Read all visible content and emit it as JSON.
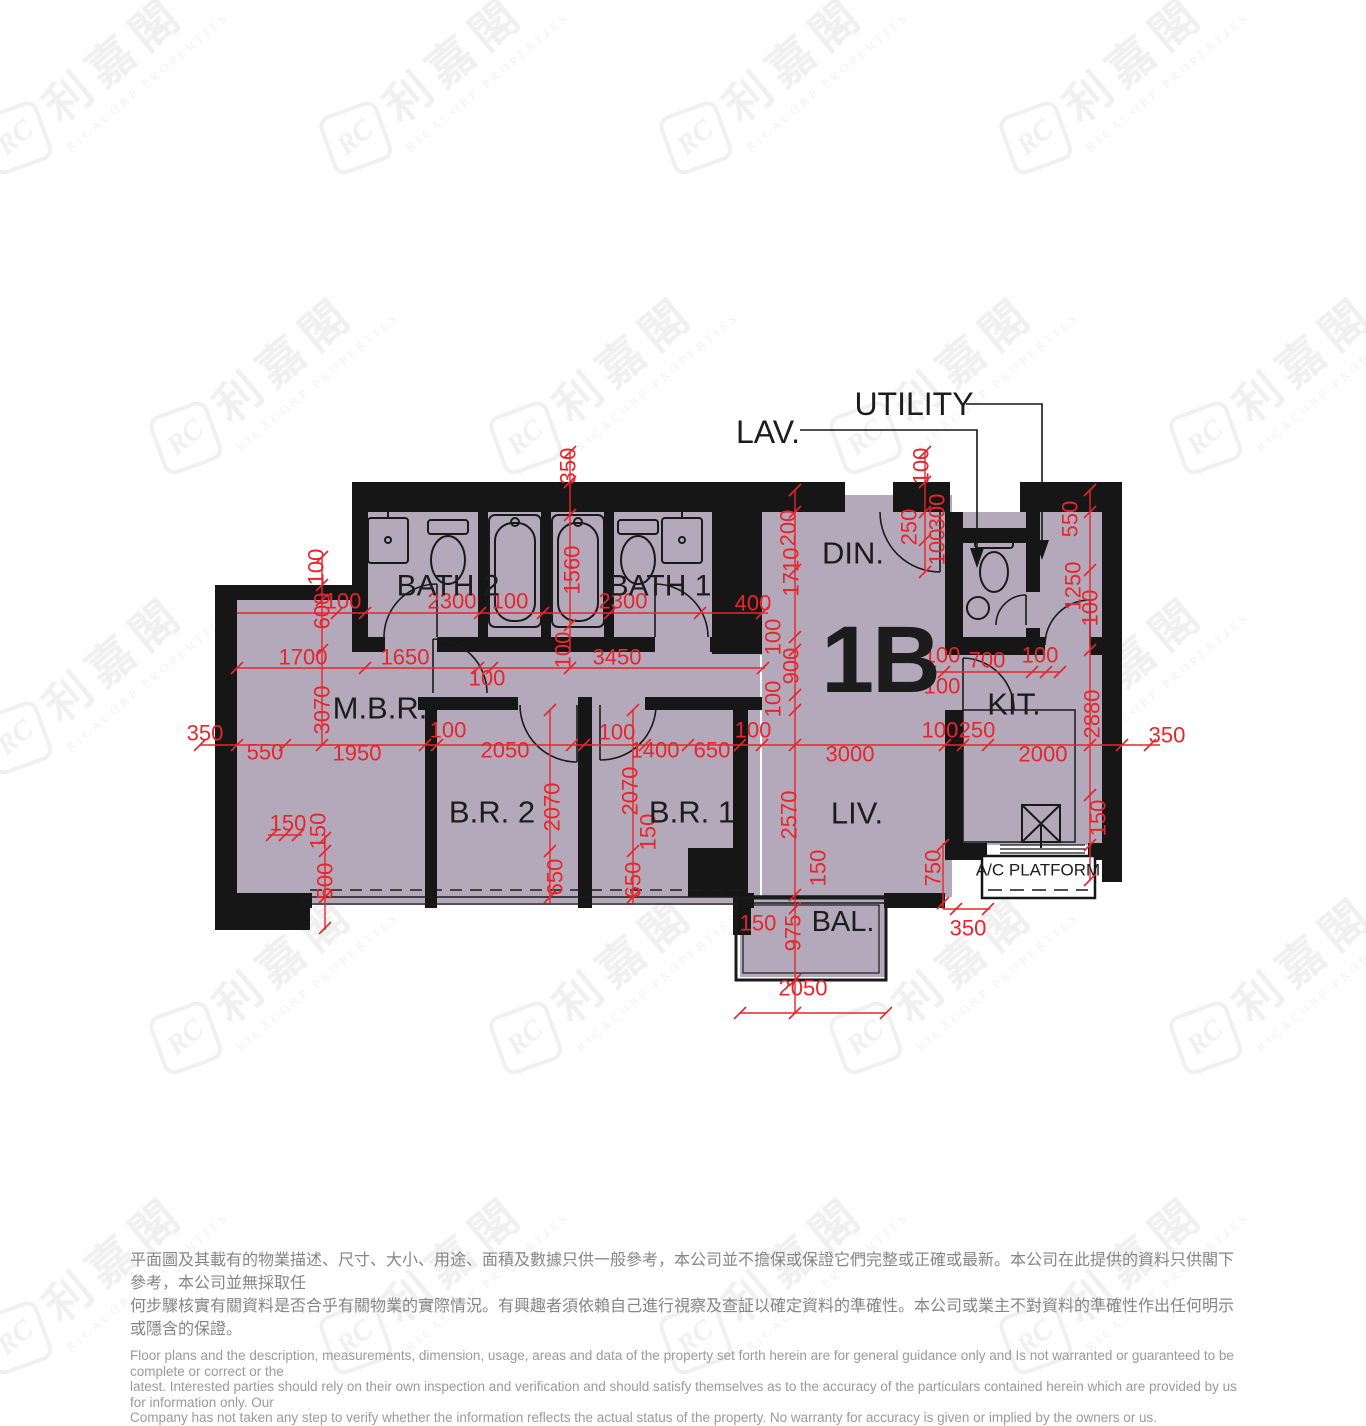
{
  "unit_label": "1B",
  "colors": {
    "floor_fill": "#b3a9ba",
    "wall_black": "#161616",
    "dimension_red": "#e8252b",
    "label_black": "#1c1c1c",
    "disclaimer_gray": "#8c8c8c"
  },
  "watermark": {
    "logo": "RC",
    "zh": "利嘉閣",
    "en": "RICACORP PROPERTIES"
  },
  "rooms": [
    {
      "id": "bath2",
      "label": "BATH 2",
      "x": 448,
      "y": 586,
      "s": 30
    },
    {
      "id": "bath1",
      "label": "BATH 1",
      "x": 660,
      "y": 586,
      "s": 30
    },
    {
      "id": "mbr",
      "label": "M.B.R.",
      "x": 380,
      "y": 708,
      "s": 31
    },
    {
      "id": "br2",
      "label": "B.R. 2",
      "x": 492,
      "y": 812,
      "s": 31
    },
    {
      "id": "br1",
      "label": "B.R. 1",
      "x": 692,
      "y": 812,
      "s": 31
    },
    {
      "id": "din",
      "label": "DIN.",
      "x": 853,
      "y": 553,
      "s": 31
    },
    {
      "id": "unit",
      "label": "1B",
      "x": 880,
      "y": 660,
      "s": 95,
      "bold": true
    },
    {
      "id": "kit",
      "label": "KIT.",
      "x": 1014,
      "y": 704,
      "s": 31
    },
    {
      "id": "liv",
      "label": "LIV.",
      "x": 857,
      "y": 813,
      "s": 31
    },
    {
      "id": "bal",
      "label": "BAL.",
      "x": 843,
      "y": 922,
      "s": 29
    },
    {
      "id": "ac",
      "label": "A/C PLATFORM",
      "x": 1038,
      "y": 870,
      "s": 17
    },
    {
      "id": "lav",
      "label": "LAV.",
      "x": 768,
      "y": 432,
      "s": 32
    },
    {
      "id": "utility",
      "label": "UTILITY",
      "x": 914,
      "y": 404,
      "s": 32
    }
  ],
  "dimensions": [
    {
      "v": "100",
      "x": 343,
      "y": 601,
      "r": 0
    },
    {
      "v": "2300",
      "x": 452,
      "y": 601,
      "r": 0
    },
    {
      "v": "100",
      "x": 510,
      "y": 601,
      "r": 0
    },
    {
      "v": "2300",
      "x": 623,
      "y": 601,
      "r": 0
    },
    {
      "v": "400",
      "x": 753,
      "y": 603,
      "r": 0
    },
    {
      "v": "350",
      "x": 568,
      "y": 466,
      "r": 1
    },
    {
      "v": "1560",
      "x": 572,
      "y": 570,
      "r": 1
    },
    {
      "v": "100",
      "x": 563,
      "y": 650,
      "r": 1
    },
    {
      "v": "200",
      "x": 788,
      "y": 528,
      "r": 1
    },
    {
      "v": "1710",
      "x": 791,
      "y": 572,
      "r": 1
    },
    {
      "v": "100",
      "x": 921,
      "y": 466,
      "r": 1
    },
    {
      "v": "300",
      "x": 937,
      "y": 512,
      "r": 1
    },
    {
      "v": "250",
      "x": 909,
      "y": 527,
      "r": 1
    },
    {
      "v": "100",
      "x": 937,
      "y": 547,
      "r": 1
    },
    {
      "v": "550",
      "x": 1070,
      "y": 519,
      "r": 1
    },
    {
      "v": "1250",
      "x": 1073,
      "y": 586,
      "r": 1
    },
    {
      "v": "100",
      "x": 1090,
      "y": 608,
      "r": 1
    },
    {
      "v": "100",
      "x": 316,
      "y": 567,
      "r": 1
    },
    {
      "v": "600",
      "x": 322,
      "y": 611,
      "r": 1
    },
    {
      "v": "1700",
      "x": 303,
      "y": 657,
      "r": 0
    },
    {
      "v": "1650",
      "x": 405,
      "y": 657,
      "r": 0
    },
    {
      "v": "3450",
      "x": 617,
      "y": 657,
      "r": 0
    },
    {
      "v": "100",
      "x": 487,
      "y": 678,
      "r": 0
    },
    {
      "v": "100",
      "x": 773,
      "y": 637,
      "r": 1
    },
    {
      "v": "900",
      "x": 791,
      "y": 666,
      "r": 1
    },
    {
      "v": "100",
      "x": 773,
      "y": 699,
      "r": 1
    },
    {
      "v": "100",
      "x": 942,
      "y": 655,
      "r": 0
    },
    {
      "v": "700",
      "x": 987,
      "y": 660,
      "r": 0
    },
    {
      "v": "100",
      "x": 1040,
      "y": 655,
      "r": 0
    },
    {
      "v": "100",
      "x": 942,
      "y": 686,
      "r": 0
    },
    {
      "v": "3070",
      "x": 322,
      "y": 710,
      "r": 1
    },
    {
      "v": "350",
      "x": 205,
      "y": 733,
      "r": 0
    },
    {
      "v": "550",
      "x": 265,
      "y": 752,
      "r": 0
    },
    {
      "v": "1950",
      "x": 357,
      "y": 753,
      "r": 0
    },
    {
      "v": "100",
      "x": 448,
      "y": 730,
      "r": 0
    },
    {
      "v": "2050",
      "x": 505,
      "y": 750,
      "r": 0
    },
    {
      "v": "100",
      "x": 617,
      "y": 732,
      "r": 0
    },
    {
      "v": "1400",
      "x": 655,
      "y": 750,
      "r": 0
    },
    {
      "v": "650",
      "x": 712,
      "y": 750,
      "r": 0
    },
    {
      "v": "100",
      "x": 753,
      "y": 730,
      "r": 0
    },
    {
      "v": "3000",
      "x": 850,
      "y": 754,
      "r": 0
    },
    {
      "v": "100",
      "x": 940,
      "y": 730,
      "r": 0
    },
    {
      "v": "250",
      "x": 977,
      "y": 730,
      "r": 0
    },
    {
      "v": "2000",
      "x": 1043,
      "y": 754,
      "r": 0
    },
    {
      "v": "2880",
      "x": 1092,
      "y": 714,
      "r": 1
    },
    {
      "v": "350",
      "x": 1167,
      "y": 735,
      "r": 0
    },
    {
      "v": "2070",
      "x": 552,
      "y": 807,
      "r": 1
    },
    {
      "v": "2070",
      "x": 630,
      "y": 791,
      "r": 1
    },
    {
      "v": "150",
      "x": 648,
      "y": 832,
      "r": 1
    },
    {
      "v": "2570",
      "x": 789,
      "y": 815,
      "r": 1
    },
    {
      "v": "650",
      "x": 555,
      "y": 877,
      "r": 1
    },
    {
      "v": "650",
      "x": 633,
      "y": 880,
      "r": 1
    },
    {
      "v": "150",
      "x": 288,
      "y": 823,
      "r": 0
    },
    {
      "v": "150",
      "x": 318,
      "y": 831,
      "r": 1
    },
    {
      "v": "500",
      "x": 325,
      "y": 881,
      "r": 1
    },
    {
      "v": "150",
      "x": 758,
      "y": 923,
      "r": 0
    },
    {
      "v": "975",
      "x": 793,
      "y": 933,
      "r": 1
    },
    {
      "v": "150",
      "x": 818,
      "y": 868,
      "r": 1
    },
    {
      "v": "2050",
      "x": 803,
      "y": 988,
      "r": 0
    },
    {
      "v": "750",
      "x": 933,
      "y": 868,
      "r": 1
    },
    {
      "v": "350",
      "x": 968,
      "y": 928,
      "r": 0
    },
    {
      "v": "150",
      "x": 1098,
      "y": 818,
      "r": 1
    }
  ],
  "disclaimer": {
    "zh": "平面圖及其載有的物業描述、尺寸、大小、用途、面積及數據只供一般參考，本公司並不擔保或保證它們完整或正確或最新。本公司在此提供的資料只供閣下參考，本公司並無採取任\n何步驟核實有關資料是否合乎有關物業的實際情況。有興趣者須依賴自己進行視察及查証以確定資料的準確性。本公司或業主不對資料的準確性作出任何明示或隱含的保證。",
    "en": "Floor plans and the description, measurements, dimension, usage, areas and data of the property set forth herein are for general guidance only and Is not warranted or guaranteed to be complete or correct or the\nlatest. Interested parties should rely on their own inspection and verification and should satisfy themselves as to the accuracy of the particulars contained herein which are provided by us for information only.  Our\nCompany has not taken any step to verify whether the information reflects the actual status of the property.  No warranty for accuracy is given or implied by the owners or us."
  }
}
